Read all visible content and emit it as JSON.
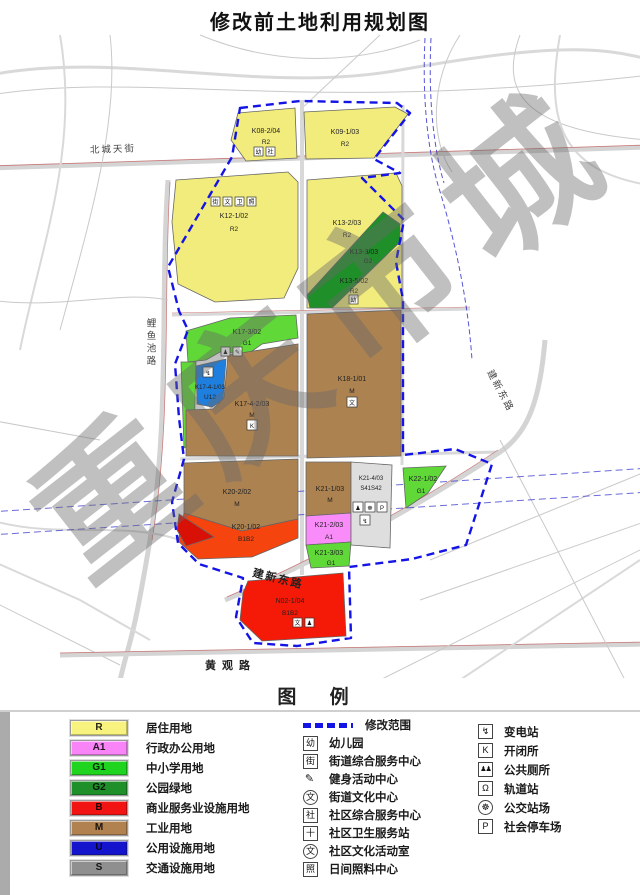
{
  "title": "修改前土地利用规划图",
  "watermark": "重庆市城",
  "boundary_color": "#1414e6",
  "map": {
    "road_labels": [
      {
        "name": "北城天街"
      },
      {
        "name": "鲤鱼池路"
      },
      {
        "name": "建新东路"
      },
      {
        "name": "建新东路"
      },
      {
        "name": "黄观路"
      }
    ],
    "parcels": [
      {
        "id": "K08-2/04",
        "code": "R2",
        "color": "#F2EC7D"
      },
      {
        "id": "K09-1/03",
        "code": "R2",
        "color": "#F2EC7D"
      },
      {
        "id": "K12-1/02",
        "code": "R2",
        "color": "#F2EC7D"
      },
      {
        "id": "K13-2/03",
        "code": "R2",
        "color": "#F2EC7D"
      },
      {
        "id": "K13-3/03",
        "code": "G2",
        "color": "#1F8F29"
      },
      {
        "id": "K13-5/02",
        "code": "R2",
        "color": "#F2EC7D"
      },
      {
        "id": "K17-3/02",
        "code": "G1",
        "color": "#5FD838"
      },
      {
        "id": "K17-4-1/03",
        "code": "U12",
        "color": "#1F7FDE"
      },
      {
        "id": "K17-4-2/03",
        "code": "M",
        "color": "#AC8251"
      },
      {
        "id": "K18-1/01",
        "code": "M",
        "color": "#AC8251"
      },
      {
        "id": "K20-2/02",
        "code": "M",
        "color": "#AC8251"
      },
      {
        "id": "K20-1/02",
        "code": "B1B2",
        "color": "#F5440E"
      },
      {
        "id": "K21-1/03",
        "code": "M",
        "color": "#AC8251"
      },
      {
        "id": "K21-2/03",
        "code": "A1",
        "color": "#F98CF9"
      },
      {
        "id": "K21-3/03",
        "code": "G1",
        "color": "#5FD838"
      },
      {
        "id": "K21-4/03",
        "code": "S41S42",
        "color": "#DEDEDE"
      },
      {
        "id": "K22-1/02",
        "code": "G1",
        "color": "#5FD838"
      },
      {
        "id": "N02-1/04",
        "code": "B1B2",
        "color": "#F51907"
      }
    ]
  },
  "legend": {
    "header": "图  例",
    "landuse": [
      {
        "code": "R",
        "label": "居住用地",
        "color": "#F7F37E"
      },
      {
        "code": "A1",
        "label": "行政办公用地",
        "color": "#F884F8"
      },
      {
        "code": "G1",
        "label": "中小学用地",
        "color": "#1ED41E"
      },
      {
        "code": "G2",
        "label": "公园绿地",
        "color": "#1F8F29"
      },
      {
        "code": "B",
        "label": "商业服务业设施用地",
        "color": "#F21313"
      },
      {
        "code": "M",
        "label": "工业用地",
        "color": "#B28150"
      },
      {
        "code": "U",
        "label": "公用设施用地",
        "color": "#1414CC"
      },
      {
        "code": "S",
        "label": "交通设施用地",
        "color": "#8F8F8F"
      }
    ],
    "symbols": [
      {
        "icon": "",
        "label": "修改范围"
      },
      {
        "icon": "幼",
        "label": "幼儿园"
      },
      {
        "icon": "街",
        "label": "街道综合服务中心"
      },
      {
        "icon": "✎",
        "label": "健身活动中心"
      },
      {
        "icon": "文",
        "label": "街道文化中心"
      },
      {
        "icon": "社",
        "label": "社区综合服务中心"
      },
      {
        "icon": "十",
        "label": "社区卫生服务站"
      },
      {
        "icon": "文",
        "label": "社区文化活动室"
      },
      {
        "icon": "照",
        "label": "日间照料中心"
      }
    ],
    "facilities": [
      {
        "icon": "↯",
        "label": "变电站"
      },
      {
        "icon": "K",
        "label": "开闭所"
      },
      {
        "icon": "♟♟",
        "label": "公共厕所"
      },
      {
        "icon": "Ω",
        "label": "轨道站"
      },
      {
        "icon": "☸",
        "label": "公交站场"
      },
      {
        "icon": "P",
        "label": "社会停车场"
      }
    ]
  }
}
